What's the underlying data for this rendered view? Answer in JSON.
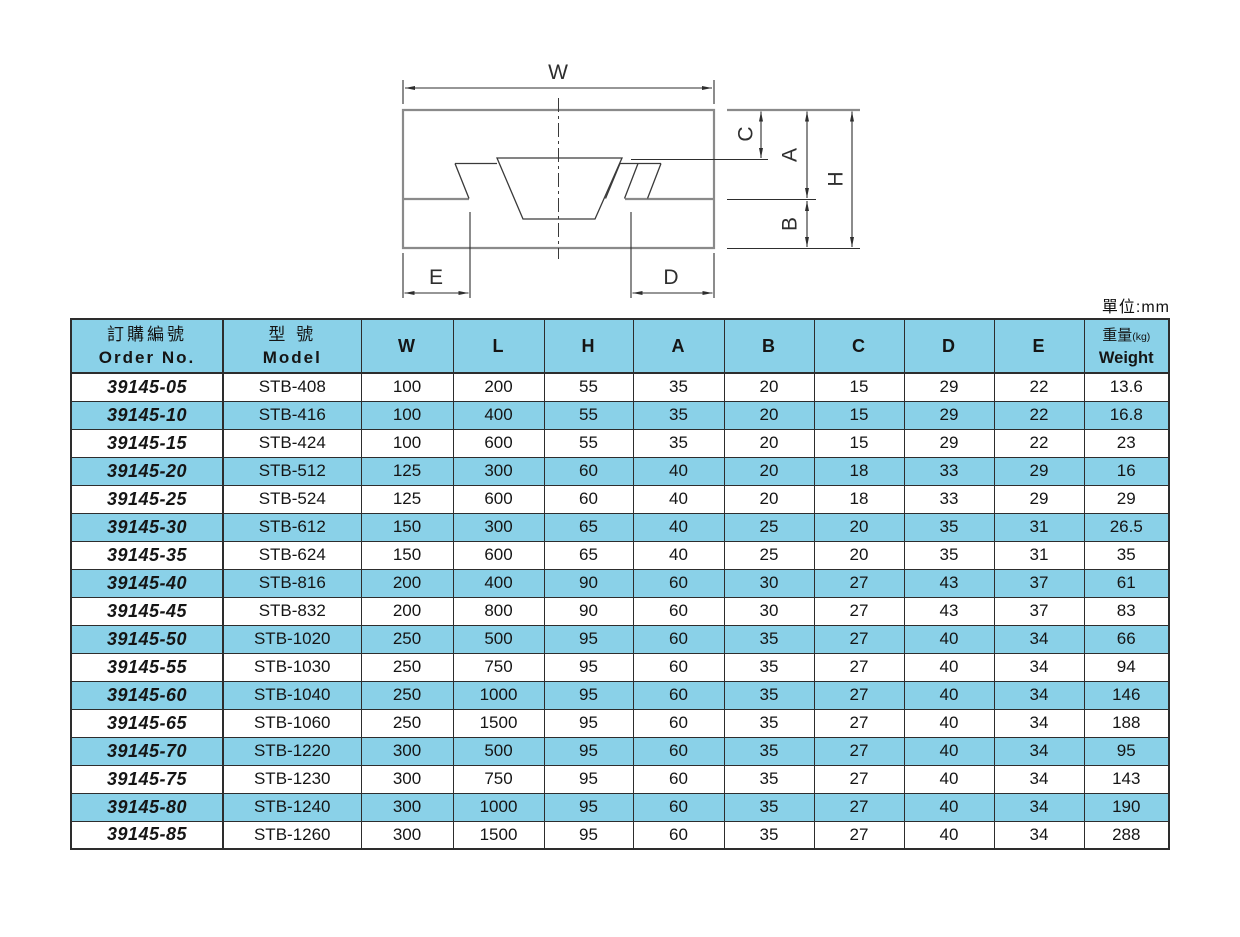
{
  "page": {
    "unit_note": "單位:mm"
  },
  "diagram": {
    "labels": {
      "w": "W",
      "e": "E",
      "d": "D",
      "c": "C",
      "a": "A",
      "b": "B",
      "h": "H"
    }
  },
  "table": {
    "header": {
      "order_zh": "訂購編號",
      "order_en": "Order No.",
      "model_zh": "型 號",
      "model_en": "Model",
      "dims": [
        "W",
        "L",
        "H",
        "A",
        "B",
        "C",
        "D",
        "E"
      ],
      "weight_zh": "重量",
      "weight_kg": "(kg)",
      "weight_en": "Weight"
    },
    "rows": [
      [
        "39145-05",
        "STB-408",
        "100",
        "200",
        "55",
        "35",
        "20",
        "15",
        "29",
        "22",
        "13.6"
      ],
      [
        "39145-10",
        "STB-416",
        "100",
        "400",
        "55",
        "35",
        "20",
        "15",
        "29",
        "22",
        "16.8"
      ],
      [
        "39145-15",
        "STB-424",
        "100",
        "600",
        "55",
        "35",
        "20",
        "15",
        "29",
        "22",
        "23"
      ],
      [
        "39145-20",
        "STB-512",
        "125",
        "300",
        "60",
        "40",
        "20",
        "18",
        "33",
        "29",
        "16"
      ],
      [
        "39145-25",
        "STB-524",
        "125",
        "600",
        "60",
        "40",
        "20",
        "18",
        "33",
        "29",
        "29"
      ],
      [
        "39145-30",
        "STB-612",
        "150",
        "300",
        "65",
        "40",
        "25",
        "20",
        "35",
        "31",
        "26.5"
      ],
      [
        "39145-35",
        "STB-624",
        "150",
        "600",
        "65",
        "40",
        "25",
        "20",
        "35",
        "31",
        "35"
      ],
      [
        "39145-40",
        "STB-816",
        "200",
        "400",
        "90",
        "60",
        "30",
        "27",
        "43",
        "37",
        "61"
      ],
      [
        "39145-45",
        "STB-832",
        "200",
        "800",
        "90",
        "60",
        "30",
        "27",
        "43",
        "37",
        "83"
      ],
      [
        "39145-50",
        "STB-1020",
        "250",
        "500",
        "95",
        "60",
        "35",
        "27",
        "40",
        "34",
        "66"
      ],
      [
        "39145-55",
        "STB-1030",
        "250",
        "750",
        "95",
        "60",
        "35",
        "27",
        "40",
        "34",
        "94"
      ],
      [
        "39145-60",
        "STB-1040",
        "250",
        "1000",
        "95",
        "60",
        "35",
        "27",
        "40",
        "34",
        "146"
      ],
      [
        "39145-65",
        "STB-1060",
        "250",
        "1500",
        "95",
        "60",
        "35",
        "27",
        "40",
        "34",
        "188"
      ],
      [
        "39145-70",
        "STB-1220",
        "300",
        "500",
        "95",
        "60",
        "35",
        "27",
        "40",
        "34",
        "95"
      ],
      [
        "39145-75",
        "STB-1230",
        "300",
        "750",
        "95",
        "60",
        "35",
        "27",
        "40",
        "34",
        "143"
      ],
      [
        "39145-80",
        "STB-1240",
        "300",
        "1000",
        "95",
        "60",
        "35",
        "27",
        "40",
        "34",
        "190"
      ],
      [
        "39145-85",
        "STB-1260",
        "300",
        "1500",
        "95",
        "60",
        "35",
        "27",
        "40",
        "34",
        "288"
      ]
    ]
  },
  "colors": {
    "cell_blue": "#8AD1E8",
    "table_border": "#2d2d2d"
  }
}
